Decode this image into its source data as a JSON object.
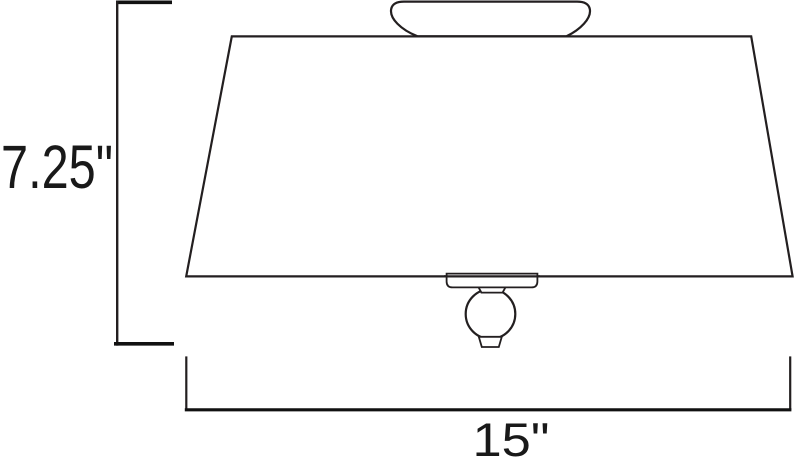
{
  "figure": {
    "type": "product-dimension-diagram",
    "subject": "flush-mount ceiling light fixture, side elevation line drawing",
    "background_color": "#ffffff",
    "line_color": "#231f20",
    "text_color": "#191919"
  },
  "dimensions": {
    "height": {
      "label": "7.25\"",
      "value": 7.25,
      "unit": "inches",
      "measures": "overall fixture height"
    },
    "width": {
      "label": "15\"",
      "value": 15,
      "unit": "inches",
      "measures": "shade bottom diameter"
    }
  },
  "components": [
    "ceiling-canopy",
    "tapered-shade",
    "mounting-plate",
    "finial-neck",
    "finial-ball",
    "finial-knob"
  ]
}
